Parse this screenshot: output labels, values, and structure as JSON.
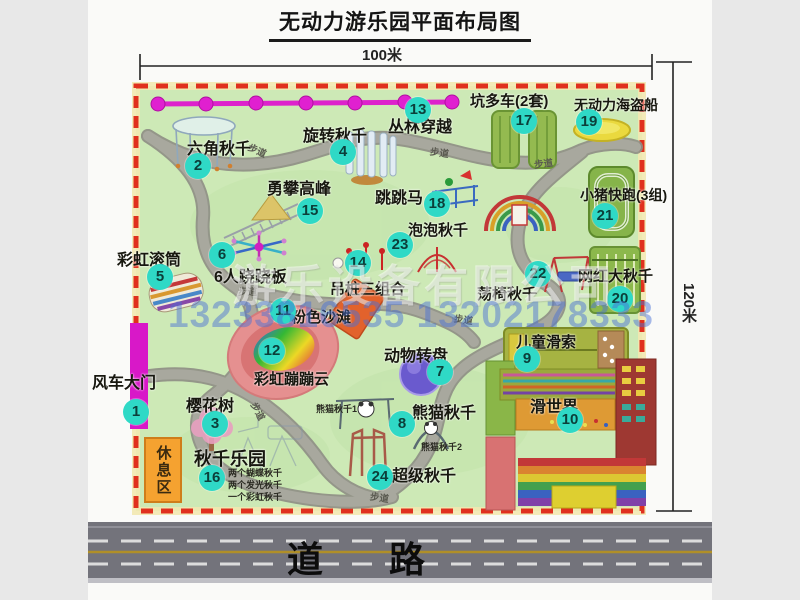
{
  "title": "无动力游乐园平面布局图",
  "dimensions": {
    "top": "100米",
    "right": "120米"
  },
  "road_label": "道 路",
  "rest_area": "休息区",
  "path_label": "步道",
  "watermarks": {
    "company": "游乐设备有限公司",
    "phone": "13233816535 13202178333"
  },
  "colors": {
    "park_green": "#cde9b6",
    "border_red": "#e0301e",
    "badge_teal": "#2fd9c6",
    "zipline_magenta": "#dd22cc",
    "road_gray": "#73737b"
  },
  "features": [
    {
      "num": "1",
      "label": "风车大门"
    },
    {
      "num": "2",
      "label": "六角秋千"
    },
    {
      "num": "3",
      "label": "樱花树"
    },
    {
      "num": "4",
      "label": "旋转秋千"
    },
    {
      "num": "5",
      "label": "彩虹滚筒"
    },
    {
      "num": "6",
      "label": "6人跷跷板"
    },
    {
      "num": "7",
      "label": "动物转盘"
    },
    {
      "num": "8",
      "label": "熊猫秋千"
    },
    {
      "num": "9",
      "label": "儿童滑索"
    },
    {
      "num": "10",
      "label": "滑世界"
    },
    {
      "num": "11",
      "label": "粉色沙滩"
    },
    {
      "num": "12",
      "label": "彩虹蹦蹦云"
    },
    {
      "num": "13",
      "label": "丛林穿越"
    },
    {
      "num": "14",
      "label": "吊桩三组合"
    },
    {
      "num": "15",
      "label": "勇攀高峰"
    },
    {
      "num": "16",
      "label": "秋千乐园"
    },
    {
      "num": "17",
      "label": "坑多车(2套)"
    },
    {
      "num": "18",
      "label": "跳跳马"
    },
    {
      "num": "19",
      "label": "无动力海盗船"
    },
    {
      "num": "20",
      "label": "网红大秋千"
    },
    {
      "num": "21",
      "label": "小猪快跑(3组)"
    },
    {
      "num": "22",
      "label": "荡椅秋千"
    },
    {
      "num": "23",
      "label": "泡泡秋千"
    },
    {
      "num": "24",
      "label": "超级秋千"
    }
  ],
  "sub_labels": {
    "panda1": "熊猫秋千1",
    "panda2": "熊猫秋千2",
    "swing_park_lines": [
      "两个蝴蝶秋千",
      "两个发光秋千",
      "一个彩虹秋千"
    ]
  }
}
